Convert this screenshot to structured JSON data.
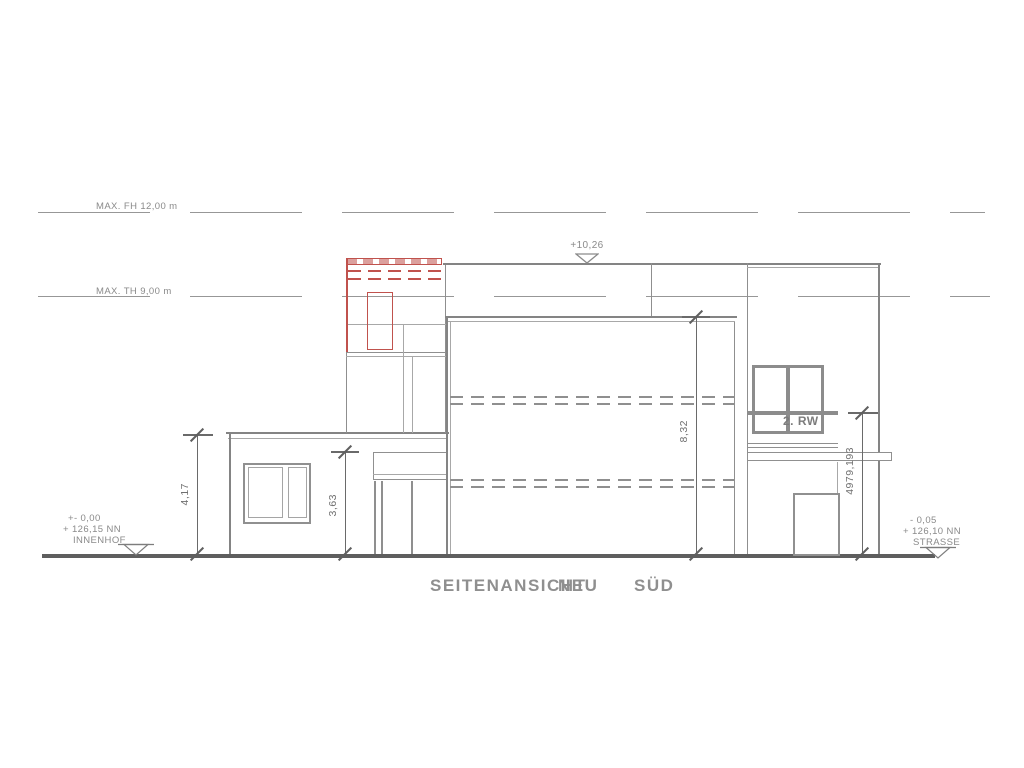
{
  "title": {
    "part1": "SEITENANSICHT",
    "part2": "NEU",
    "part3": "SÜD"
  },
  "regulation": {
    "max_fh": "MAX. FH 12,00 m",
    "max_th": "MAX. TH 9,00 m"
  },
  "levels": {
    "roof": "+10,26"
  },
  "dimensions": {
    "left_outer": "4,17",
    "left_inner": "3,63",
    "main": "8,32",
    "right": "4979,193"
  },
  "annotations": {
    "rw": "2. RW"
  },
  "ground_left": {
    "line1": "+- 0,00",
    "line2": "+ 126,15 NN",
    "line3": "INNENHOF"
  },
  "ground_right": {
    "line1": "- 0,05",
    "line2": "+ 126,10 NN",
    "line3": "STRASSE"
  },
  "colors": {
    "line_grey": "#8f8f8f",
    "line_dark": "#5e5e5e",
    "highlight_red": "#c0524d",
    "text_grey": "#8a8a8a"
  }
}
